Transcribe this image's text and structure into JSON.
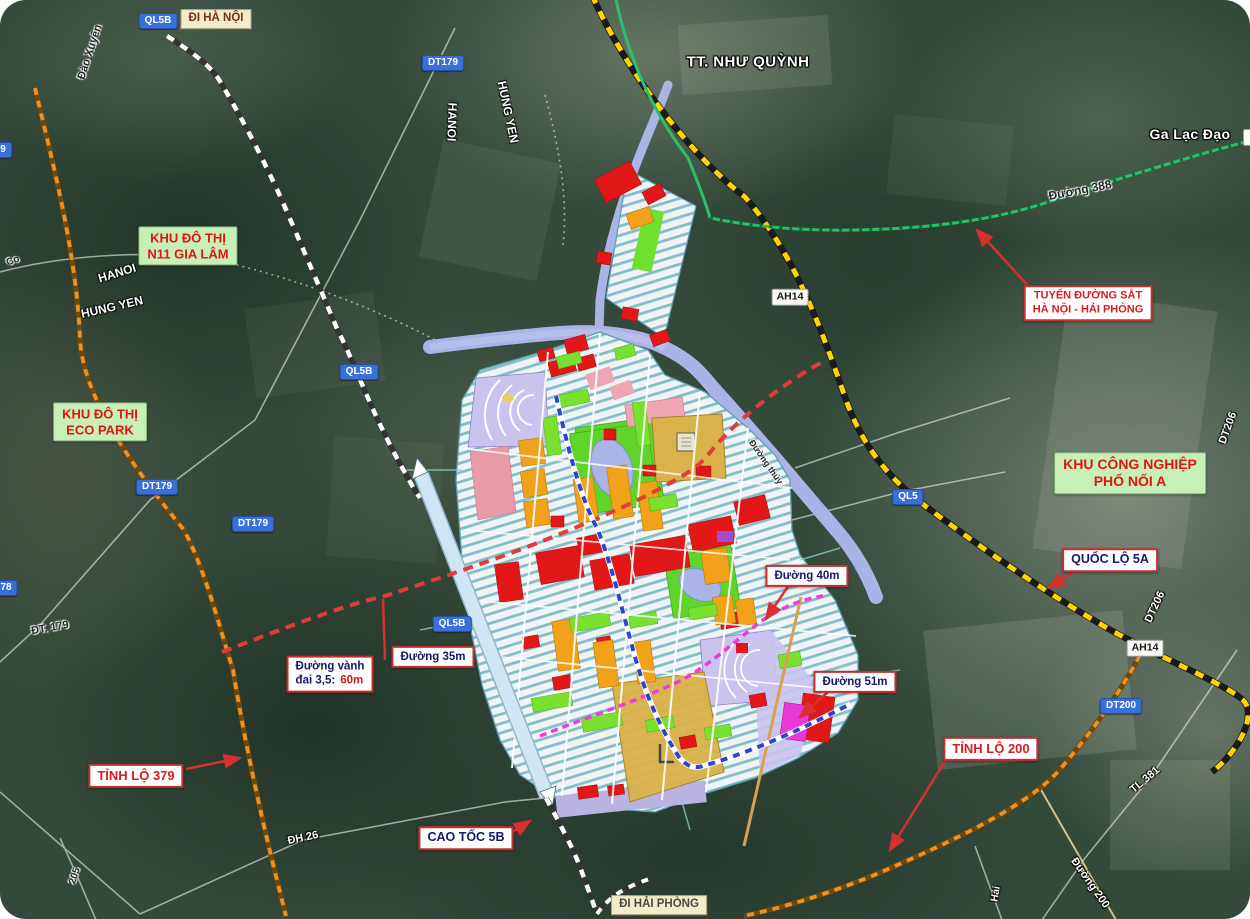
{
  "map": {
    "shields_blue": [
      {
        "label": "QL5B",
        "x": 158,
        "y": 21
      },
      {
        "label": "DT179",
        "x": 443,
        "y": 63
      },
      {
        "label": "QL5B",
        "x": 359,
        "y": 372
      },
      {
        "label": "QL5B",
        "x": 452,
        "y": 624
      },
      {
        "label": "DT179",
        "x": 157,
        "y": 487
      },
      {
        "label": "DT179",
        "x": 253,
        "y": 524
      },
      {
        "label": "78",
        "x": 6,
        "y": 588
      },
      {
        "label": "9",
        "x": 3,
        "y": 150
      },
      {
        "label": "QL5",
        "x": 908,
        "y": 497
      },
      {
        "label": "DT200",
        "x": 1121,
        "y": 706
      }
    ],
    "shields_white": [
      {
        "label": "AH14",
        "x": 790,
        "y": 297
      },
      {
        "label": "AH14",
        "x": 1145,
        "y": 648
      }
    ],
    "direction_badges": [
      {
        "label": "ĐI HÀ NỘI",
        "x": 216,
        "y": 19,
        "color": "#7a2e1c"
      },
      {
        "label": "ĐI HẢI PHÒNG",
        "x": 659,
        "y": 905,
        "color": "#4a4a40"
      }
    ],
    "area_boxes": [
      {
        "lines": [
          "KHU ĐÔ THỊ",
          "N11 GIA LÂM"
        ],
        "x": 188,
        "y": 246,
        "big": false
      },
      {
        "lines": [
          "KHU ĐÔ THỊ",
          "ECO PARK"
        ],
        "x": 100,
        "y": 422,
        "big": false
      },
      {
        "lines": [
          "KHU CÔNG NGHIỆP",
          "PHỐ NỐI A"
        ],
        "x": 1130,
        "y": 473,
        "big": true
      }
    ],
    "callouts": [
      {
        "lines": [
          "TUYẾN ĐƯỜNG SẮT",
          "HÀ NỘI - HẢI PHÒNG"
        ],
        "x": 1088,
        "y": 303,
        "style": "red small"
      },
      {
        "lines": [
          "TỈNH LỘ 379"
        ],
        "x": 136,
        "y": 776,
        "style": "red"
      },
      {
        "lines": [
          "TỈNH LỘ 200"
        ],
        "x": 991,
        "y": 749,
        "style": "red"
      },
      {
        "lines": [
          "CAO TỐC 5B"
        ],
        "x": 466,
        "y": 838,
        "style": "navy mid"
      },
      {
        "lines": [
          "QUỐC LỘ 5A"
        ],
        "x": 1110,
        "y": 560,
        "style": "navy mid"
      },
      {
        "lines": [
          "Đường 40m"
        ],
        "x": 807,
        "y": 576,
        "style": "navy"
      },
      {
        "lines": [
          "Đường 51m"
        ],
        "x": 855,
        "y": 682,
        "style": "navy"
      },
      {
        "lines": [
          "Đường 35m"
        ],
        "x": 433,
        "y": 657,
        "style": "navy"
      },
      {
        "lines": [
          "Đường vành",
          "đai 3,5:"
        ],
        "highlight": "60m",
        "x": 330,
        "y": 674,
        "style": "navy"
      }
    ],
    "place_labels": [
      {
        "label": "TT. NHƯ QUỲNH",
        "x": 748,
        "y": 62,
        "size": 15
      },
      {
        "label": "Ga Lạc Đạo",
        "x": 1190,
        "y": 134,
        "size": 14
      }
    ],
    "road_labels": [
      {
        "label": "Đào Xuyên",
        "x": 90,
        "y": 52,
        "rot": -72,
        "style": "dark",
        "size": 11
      },
      {
        "label": "HANOI",
        "x": 452,
        "y": 122,
        "rot": 92,
        "style": "light",
        "size": 12
      },
      {
        "label": "HUNG YEN",
        "x": 508,
        "y": 112,
        "rot": 78,
        "style": "light",
        "size": 12
      },
      {
        "label": "HANOI",
        "x": 117,
        "y": 273,
        "rot": -17,
        "style": "light",
        "size": 12
      },
      {
        "label": "HUNG YEN",
        "x": 112,
        "y": 307,
        "rot": -13,
        "style": "light",
        "size": 12
      },
      {
        "label": "Co",
        "x": 13,
        "y": 261,
        "rot": -20,
        "style": "dark",
        "size": 10
      },
      {
        "label": "ĐT. 179",
        "x": 50,
        "y": 628,
        "rot": -10,
        "style": "dark",
        "size": 11
      },
      {
        "label": "ĐH 26",
        "x": 303,
        "y": 838,
        "rot": -12,
        "style": "light",
        "size": 11
      },
      {
        "label": "205",
        "x": 75,
        "y": 876,
        "rot": -72,
        "style": "dark",
        "size": 10
      },
      {
        "label": "TL 381",
        "x": 1145,
        "y": 780,
        "rot": -40,
        "style": "light",
        "size": 11
      },
      {
        "label": "Đường 200",
        "x": 1090,
        "y": 883,
        "rot": 55,
        "style": "light",
        "size": 11
      },
      {
        "label": "Hải",
        "x": 996,
        "y": 894,
        "rot": -80,
        "style": "light",
        "size": 10
      },
      {
        "label": "Đường 388",
        "x": 1080,
        "y": 190,
        "rot": -11,
        "style": "dark",
        "size": 12
      },
      {
        "label": "DT206",
        "x": 1155,
        "y": 607,
        "rot": -65,
        "style": "light",
        "size": 11
      },
      {
        "label": "DT206",
        "x": 1228,
        "y": 428,
        "rot": -70,
        "style": "light",
        "size": 11
      },
      {
        "label": "Đường thủy",
        "x": 766,
        "y": 462,
        "rot": 55,
        "style": "dark",
        "size": 9
      }
    ],
    "legend_colors": {
      "expressway_dash": "#ffffff",
      "national_road": "#ffd400",
      "railway": "#28c06a",
      "province_road": "#f09020",
      "ring_road": "#e23b3b",
      "planned_40m": "#ef3ae0",
      "metro_line": "#2b46cc",
      "river": "#a9b3e6"
    }
  }
}
